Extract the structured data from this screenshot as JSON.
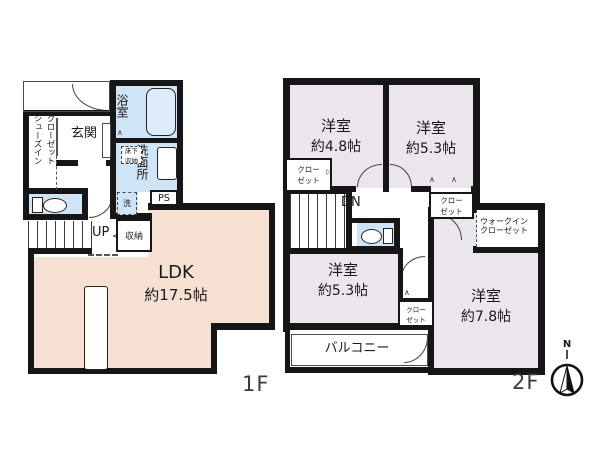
{
  "colors": {
    "wall": "#161616",
    "ldk_fill": "#f6e0d2",
    "water_fill": "#cfe4f4",
    "room_fill": "#ebe5ee",
    "tub_fill": "#ddecf8",
    "text": "#1a1a1a"
  },
  "floor1": {
    "floor_label": "1F",
    "entrance": "玄関",
    "shoes_closet_line1": "シューズイン",
    "shoes_closet_line2": "クローゼット",
    "bathroom": "浴室",
    "washroom": "洗面所",
    "underfloor_line1": "床下",
    "underfloor_line2": "収納",
    "washer": "洗",
    "pipe_space": "PS",
    "stairs_up": "UP",
    "stairs_up_arrow": "<",
    "storage": "収納",
    "ldk_name": "LDK",
    "ldk_size": "約17.5帖"
  },
  "floor2": {
    "floor_label": "2F",
    "bedroom_48_name": "洋室",
    "bedroom_48_size": "約4.8帖",
    "bedroom_53a_name": "洋室",
    "bedroom_53a_size": "約5.3帖",
    "bedroom_53b_name": "洋室",
    "bedroom_53b_size": "約5.3帖",
    "bedroom_78_name": "洋室",
    "bedroom_78_size": "約7.8帖",
    "closet_line1": "クロー",
    "closet_line2": "ゼット",
    "walkin_line1": "ウォークイン",
    "walkin_line2": "クローゼット",
    "stairs_down": "DN",
    "balcony": "バルコニー",
    "compass_north": "N",
    "fold_mark": "∧",
    "slide_mark": "▷"
  }
}
